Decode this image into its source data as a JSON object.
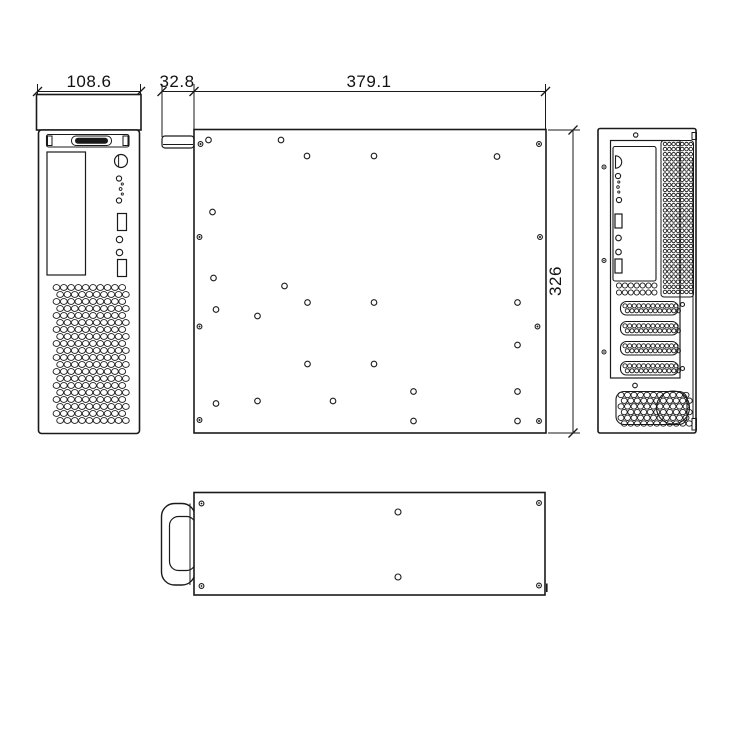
{
  "drawing": {
    "colors": {
      "background": "#ffffff",
      "line": "#1a1a1a"
    },
    "dimensions": {
      "front_width": "108.6",
      "handle_depth": "32.8",
      "body_length": "379.1",
      "body_height": "326"
    },
    "front_view": {
      "ports": [
        {
          "type": "power-button",
          "x": 121,
          "y": 161,
          "r": 6.5
        },
        {
          "type": "led",
          "x": 119,
          "y": 178.5,
          "r": 2.6
        },
        {
          "type": "led-dot",
          "x": 122.3,
          "y": 184,
          "r": 1.1
        },
        {
          "type": "led-dot",
          "x": 120.6,
          "y": 189,
          "r": 1.4
        },
        {
          "type": "led-dot",
          "x": 122.3,
          "y": 194,
          "r": 1.1
        },
        {
          "type": "led",
          "x": 119,
          "y": 200.5,
          "r": 2.6
        },
        {
          "type": "usb-port",
          "x": 117.5,
          "y": 213.5,
          "w": 9,
          "h": 17
        },
        {
          "type": "audio-jack",
          "x": 119.5,
          "y": 239.5,
          "r": 3.2
        },
        {
          "type": "audio-jack",
          "x": 119.5,
          "y": 252.5,
          "r": 3.2
        },
        {
          "type": "usb-port",
          "x": 117.5,
          "y": 259.5,
          "w": 9,
          "h": 17
        }
      ],
      "vent": {
        "x": 56.5,
        "y": 287.5,
        "cols": 10,
        "rows": 20,
        "dx": 7.3,
        "dy": 7.0,
        "rx": 3.4,
        "ry": 2.9,
        "offset": 3.65
      }
    },
    "side_view": {
      "holes": [
        [
          200.5,
          144,
          "edge"
        ],
        [
          208.5,
          140,
          "open"
        ],
        [
          281,
          140,
          "open"
        ],
        [
          307,
          156,
          "open"
        ],
        [
          374,
          156,
          "open"
        ],
        [
          497,
          156.5,
          "open"
        ],
        [
          539,
          144,
          "edge"
        ],
        [
          212.5,
          212,
          "open"
        ],
        [
          199.5,
          237,
          "edge"
        ],
        [
          540,
          237,
          "edge"
        ],
        [
          213.5,
          278,
          "open"
        ],
        [
          284.5,
          286,
          "open"
        ],
        [
          307.5,
          302.5,
          "open"
        ],
        [
          374,
          302.5,
          "open"
        ],
        [
          517.5,
          302.5,
          "open"
        ],
        [
          216,
          309.5,
          "open"
        ],
        [
          257.5,
          316,
          "open"
        ],
        [
          199.5,
          326.5,
          "edge"
        ],
        [
          537.5,
          326.5,
          "edge"
        ],
        [
          517.5,
          345,
          "open"
        ],
        [
          307.5,
          364,
          "open"
        ],
        [
          374,
          364,
          "open"
        ],
        [
          413.5,
          391.5,
          "open"
        ],
        [
          517.5,
          391.5,
          "open"
        ],
        [
          257.5,
          401,
          "open"
        ],
        [
          333,
          401,
          "open"
        ],
        [
          216,
          403.5,
          "open"
        ],
        [
          199.5,
          420,
          "edge"
        ],
        [
          413.5,
          421,
          "open"
        ],
        [
          517.5,
          421,
          "open"
        ],
        [
          539,
          421,
          "edge"
        ]
      ]
    },
    "rear_view": {
      "io_ports": [
        {
          "type": "ps2-port",
          "x": 615.5,
          "y": 162,
          "r": 6.2
        },
        {
          "type": "led",
          "x": 618,
          "y": 176,
          "r": 2.6
        },
        {
          "type": "led-dot",
          "x": 618.8,
          "y": 182,
          "r": 1.1
        },
        {
          "type": "led-dot",
          "x": 618,
          "y": 187,
          "r": 1.3
        },
        {
          "type": "led-dot",
          "x": 618.8,
          "y": 192,
          "r": 1.1
        },
        {
          "type": "led",
          "x": 619,
          "y": 200,
          "r": 2.6
        },
        {
          "type": "usb-port",
          "x": 615,
          "y": 214,
          "w": 7,
          "h": 14
        },
        {
          "type": "audio-jack",
          "x": 618.5,
          "y": 238,
          "r": 2.8
        },
        {
          "type": "audio-jack",
          "x": 618.5,
          "y": 252,
          "r": 2.8
        },
        {
          "type": "usb-port",
          "x": 615,
          "y": 259,
          "w": 7,
          "h": 14
        }
      ],
      "io_grid": {
        "x": 619,
        "y": 285.5,
        "cols": 7,
        "rows": 2,
        "dx": 5.9,
        "dy": 7,
        "r": 2.6
      },
      "vent_grid": {
        "x": 665,
        "y": 144,
        "cols": 7,
        "rows": 30,
        "dx": 4.3,
        "dy": 5.1,
        "r": 1.75
      },
      "slots": [
        {
          "x": 620.5,
          "y": 301.5,
          "w": 57.5,
          "h": 13.5
        },
        {
          "x": 620.5,
          "y": 321.5,
          "w": 57.5,
          "h": 13.5
        },
        {
          "x": 620.5,
          "y": 341.5,
          "w": 57.5,
          "h": 13.5
        },
        {
          "x": 620.5,
          "y": 361.5,
          "w": 57.5,
          "h": 13.5
        }
      ],
      "slot_holes": {
        "cols": 12,
        "dx": 4.65,
        "r": 2.05
      },
      "slot_screws": [
        [
          682.5,
          304.5
        ],
        [
          682.5,
          368.5
        ]
      ],
      "edge_screws": [
        [
          604,
          167
        ],
        [
          604,
          260.5
        ],
        [
          604,
          352
        ]
      ],
      "psu_vent": {
        "x": 621,
        "y": 395,
        "cols": 11,
        "rows": 6,
        "dx": 6.5,
        "dy": 5.7,
        "rx": 3.0,
        "ry": 2.7,
        "offset": 3.25
      }
    },
    "top_view": {
      "corner_screws": [
        [
          201.5,
          503.5
        ],
        [
          539,
          503
        ],
        [
          201.5,
          586
        ],
        [
          539,
          585.5
        ]
      ],
      "center_holes": [
        [
          398,
          512
        ],
        [
          398,
          577
        ]
      ]
    }
  }
}
